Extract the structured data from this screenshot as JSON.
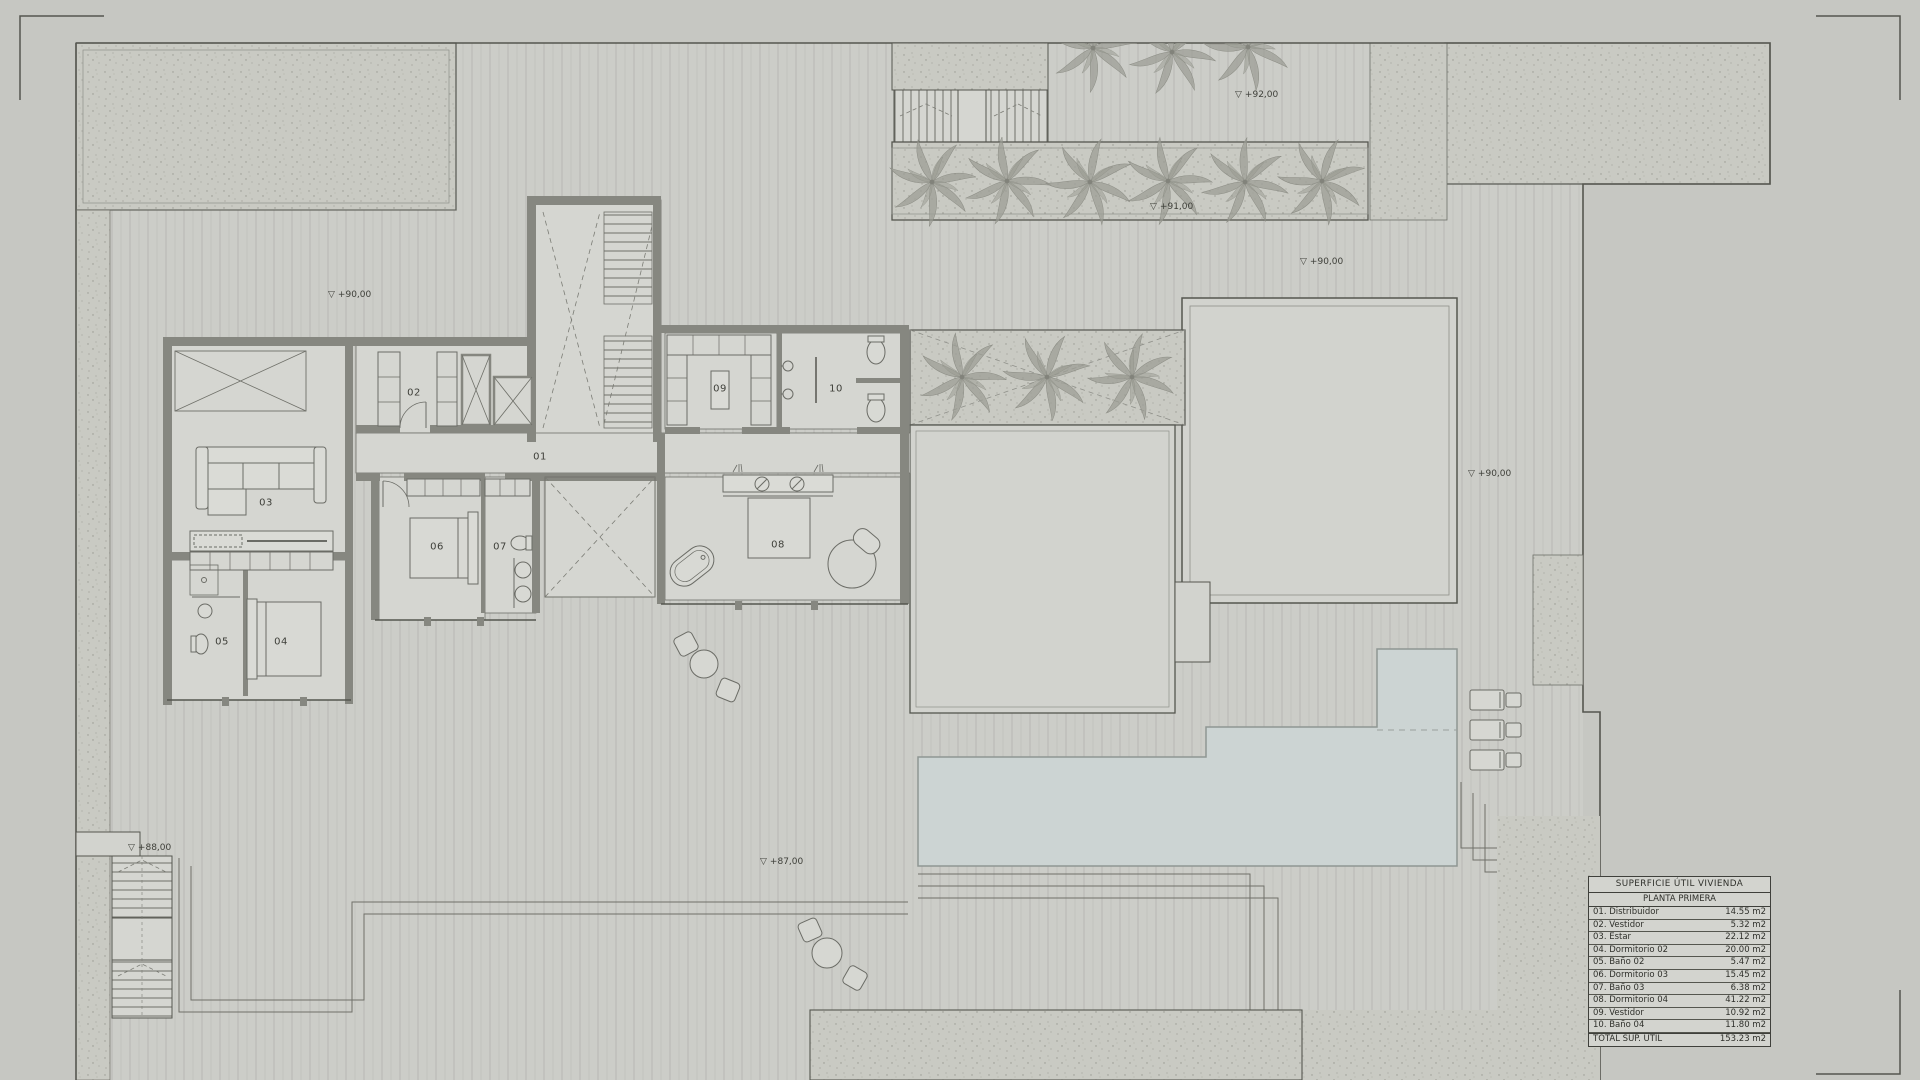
{
  "document": {
    "kind": "architectural floor plan",
    "floor": "first floor"
  },
  "symbols": {
    "elevation": "▽"
  },
  "room_labels": [
    {
      "num": "01"
    },
    {
      "num": "02"
    },
    {
      "num": "03"
    },
    {
      "num": "04"
    },
    {
      "num": "05"
    },
    {
      "num": "06"
    },
    {
      "num": "07"
    },
    {
      "num": "08"
    },
    {
      "num": "09"
    },
    {
      "num": "10"
    }
  ],
  "elevations": [
    {
      "value": "+90,00"
    },
    {
      "value": "+92,00"
    },
    {
      "value": "+91,00"
    },
    {
      "value": "+90,00"
    },
    {
      "value": "+90,00"
    },
    {
      "value": "+88,00"
    },
    {
      "value": "+87,00"
    }
  ],
  "area_table": {
    "title": "SUPERFICIE ÚTIL VIVIENDA",
    "subtitle": "PLANTA PRIMERA",
    "rows": [
      {
        "name": "01. Distribuidor",
        "area": "14.55 m2"
      },
      {
        "name": "02. Vestidor",
        "area": "5.32 m2"
      },
      {
        "name": "03. Estar",
        "area": "22.12 m2"
      },
      {
        "name": "04. Dormitorio 02",
        "area": "20.00 m2"
      },
      {
        "name": "05. Baño 02",
        "area": "5.47 m2"
      },
      {
        "name": "06. Dormitorio 03",
        "area": "15.45 m2"
      },
      {
        "name": "07. Baño 03",
        "area": "6.38 m2"
      },
      {
        "name": "08. Dormitorio 04",
        "area": "41.22 m2"
      },
      {
        "name": "09. Vestidor",
        "area": "10.92 m2"
      },
      {
        "name": "10. Baño 04",
        "area": "11.80 m2"
      }
    ],
    "total": {
      "name": "TOTAL SUP. ÚTIL",
      "area": "153.23 m2"
    }
  },
  "colors": {
    "page": "#c6c7c2",
    "deck": "#cccdc8",
    "gravel": "#c9cac3",
    "floor": "#d5d6d1",
    "terrace": "#d2d3ce",
    "wall": "#868780",
    "pool": "#ccd4d3",
    "line": "#55564f"
  }
}
